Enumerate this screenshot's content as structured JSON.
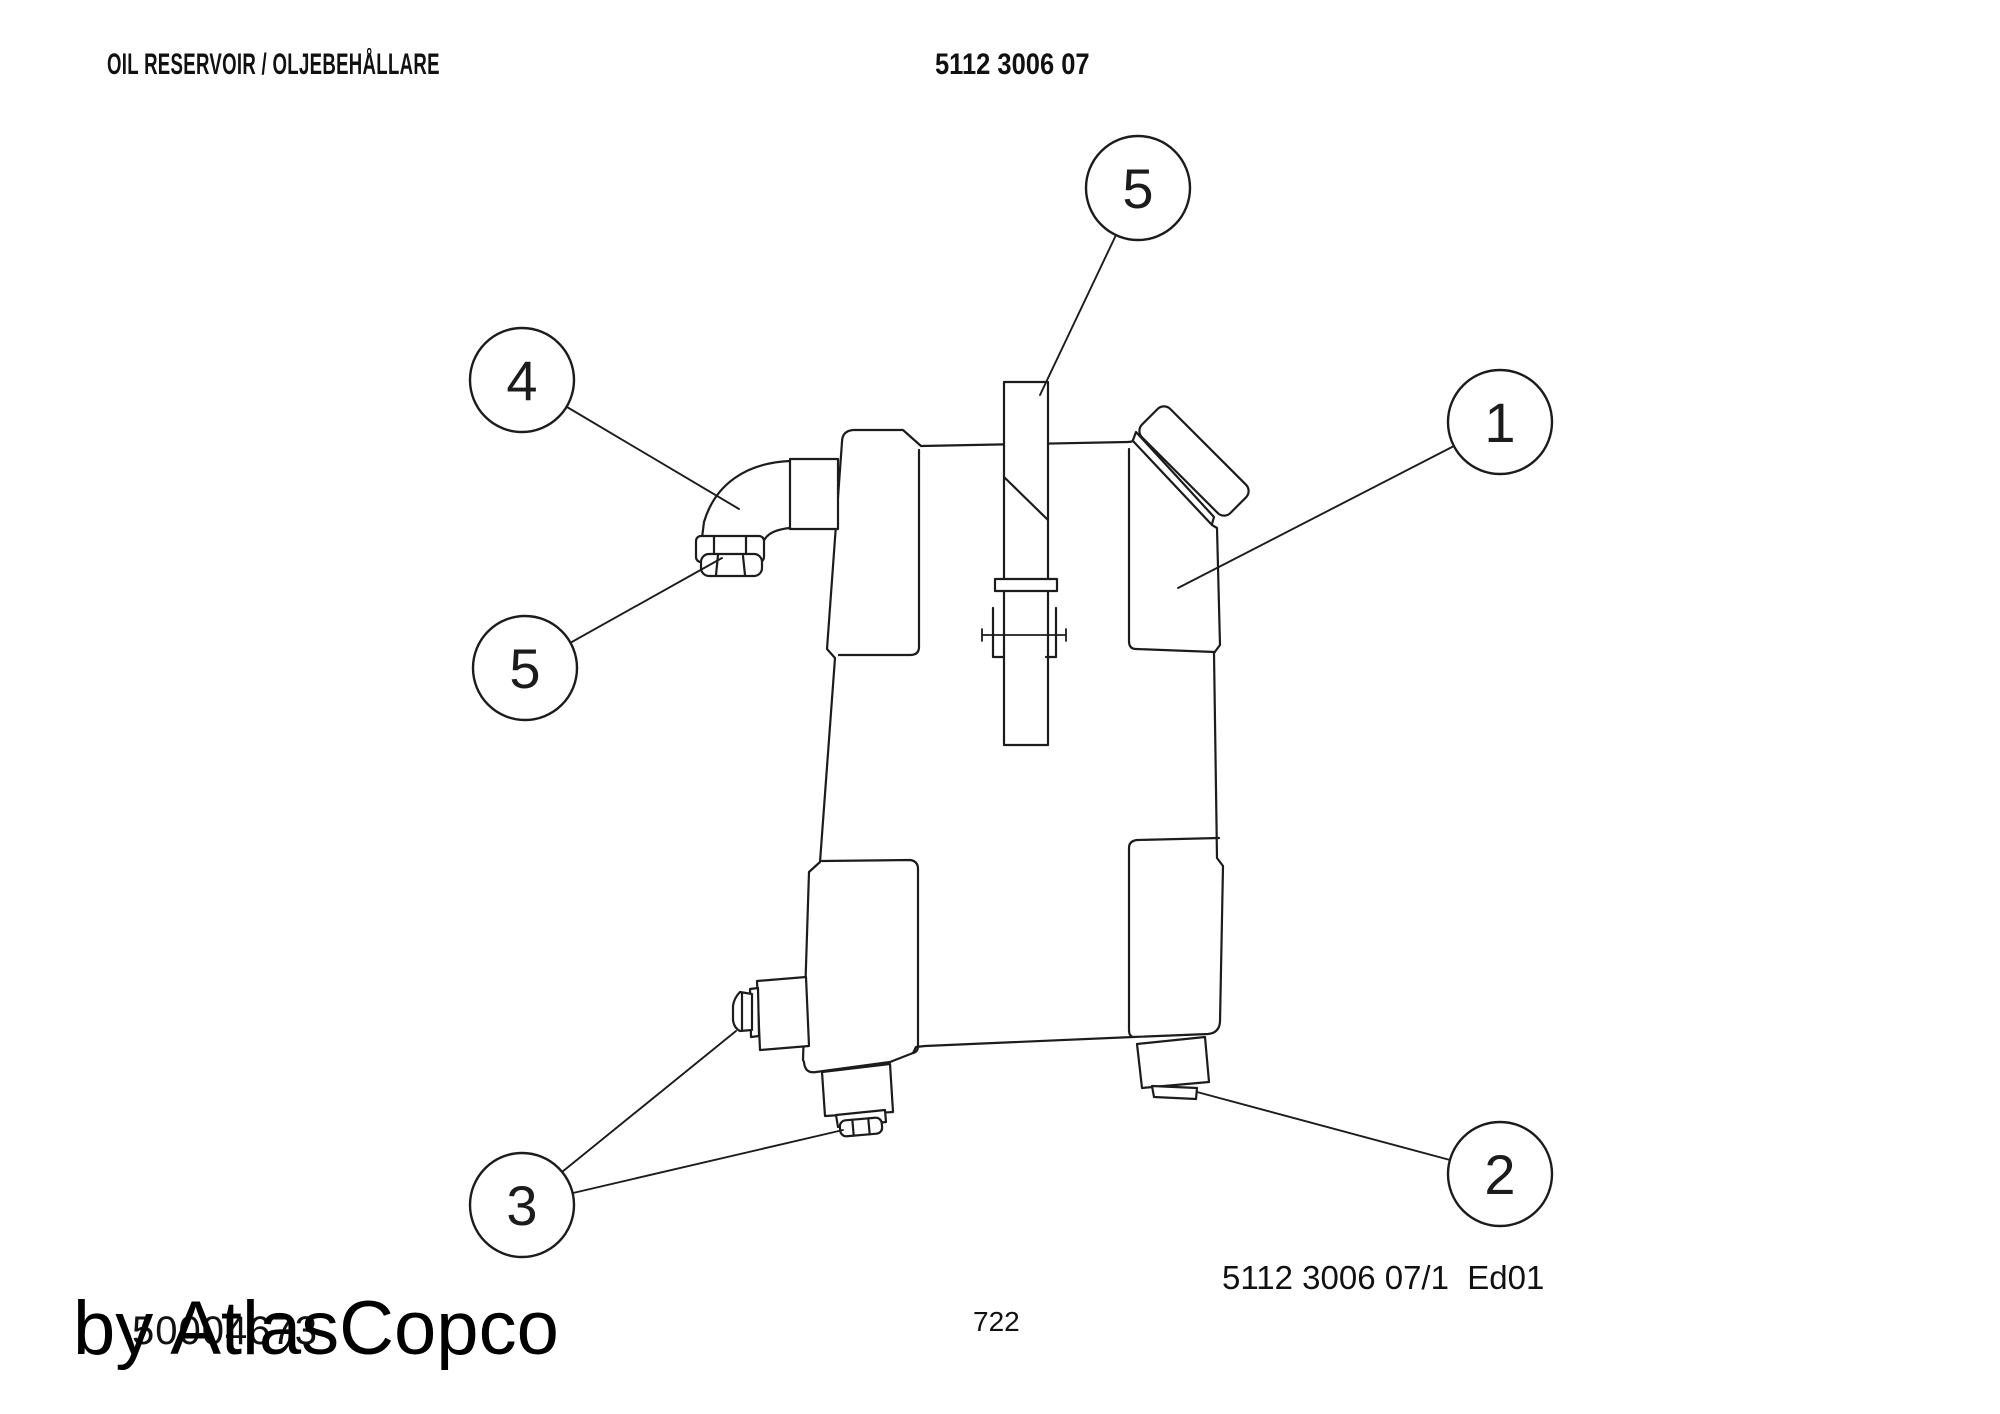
{
  "header": {
    "title": "OIL RESERVOIR / OLJEBEHÅLLARE",
    "part_number": "5112 3006 07"
  },
  "drawing": {
    "subject": "Oil reservoir side view, exploded-parts callouts",
    "callouts": [
      {
        "label": "5"
      },
      {
        "label": "4"
      },
      {
        "label": "1"
      },
      {
        "label": "5"
      },
      {
        "label": "3"
      },
      {
        "label": "2"
      }
    ]
  },
  "footer": {
    "edition_reference": "5112 3006 07/1  Ed01",
    "page_number": "722",
    "watermark": "by AtlasCopco",
    "stamp_number": "50004673"
  },
  "colors": {
    "line": "#1c1c1c",
    "background": "#ffffff"
  }
}
